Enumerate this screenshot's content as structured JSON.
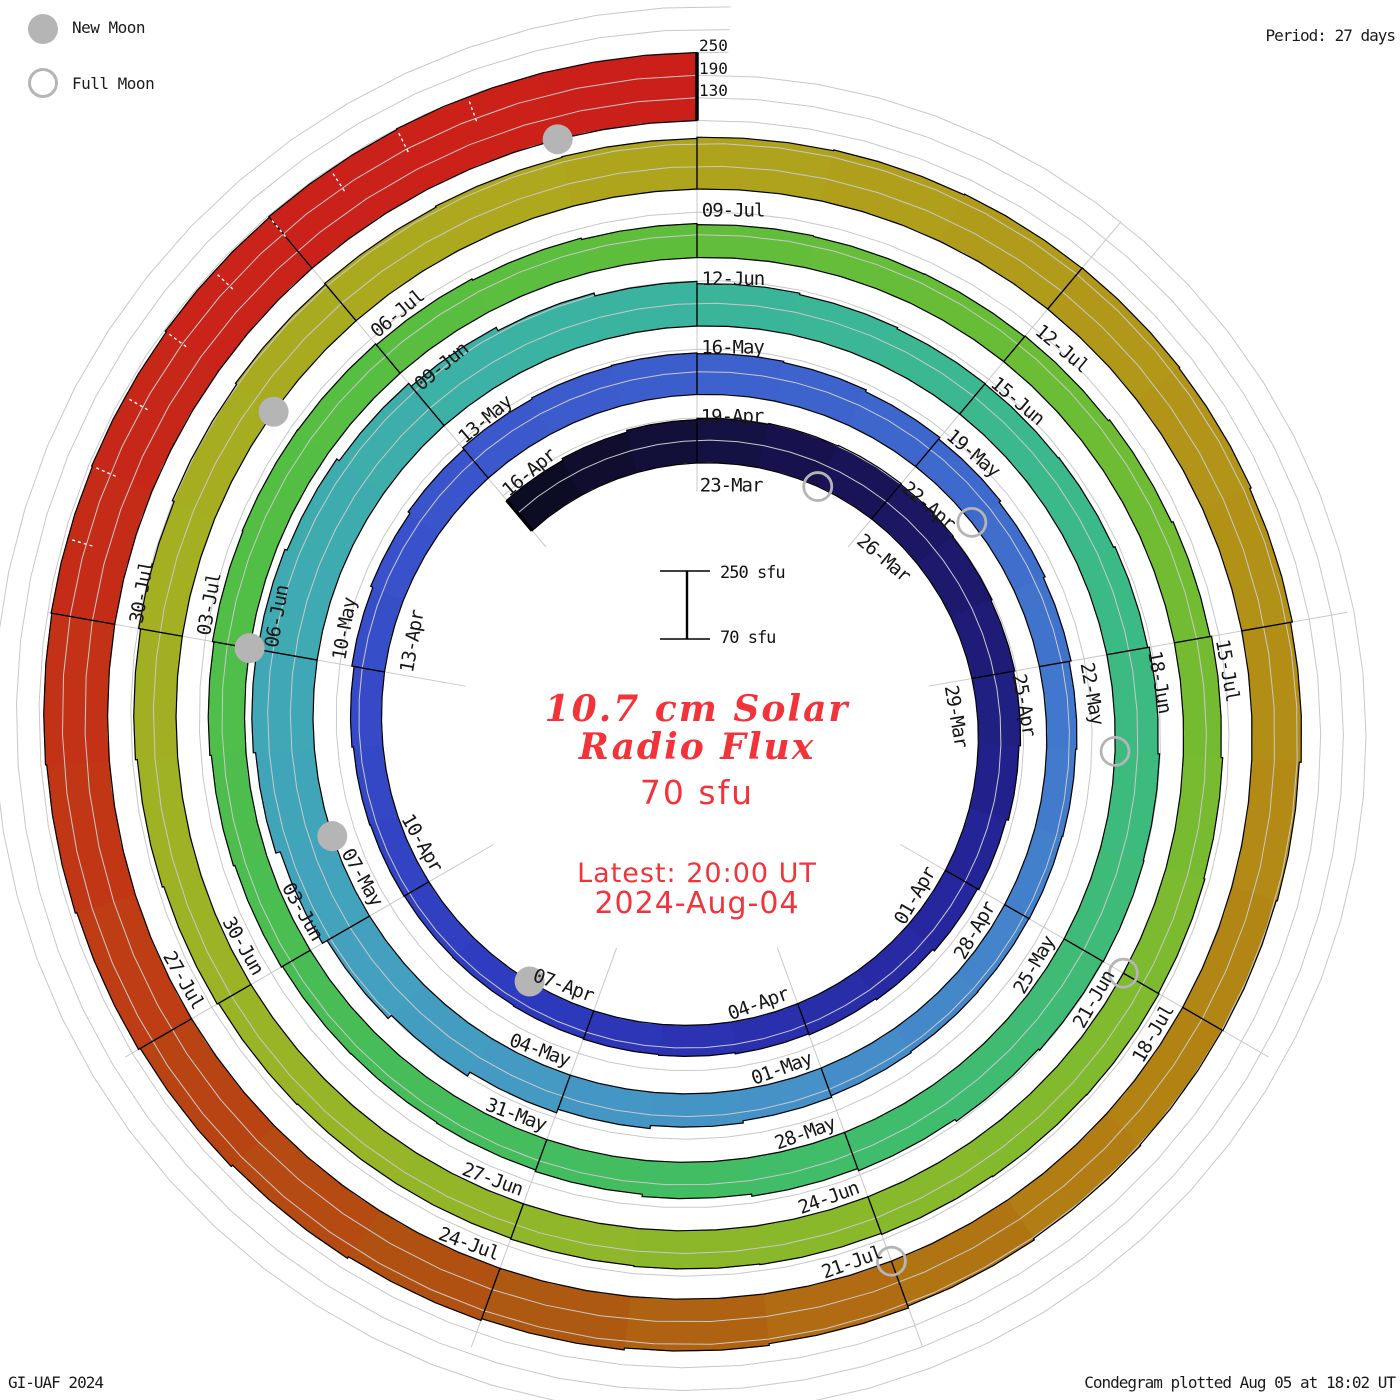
{
  "legend": {
    "new_moon": "New Moon",
    "full_moon": "Full Moon"
  },
  "header": {
    "period_label": "Period: 27 days"
  },
  "footer": {
    "left": "GI-UAF 2024",
    "right": "Condegram plotted Aug 05 at 18:02 UT"
  },
  "outer_scale_labels": [
    "250",
    "190",
    "130"
  ],
  "center": {
    "scale_top_label": "250 sfu",
    "scale_bottom_label": "70 sfu",
    "title_line1": "10.7 cm Solar",
    "title_line2": "Radio Flux",
    "baseline_label": "70 sfu",
    "latest_line1": "Latest: 20:00 UT",
    "latest_line2": "2024-Aug-04"
  },
  "colors": {
    "moon_gray": "#b5b5b5",
    "grid_gray": "#c8c8c8",
    "red_text": "#f2333a",
    "outline_black": "#000000"
  },
  "chart_data": {
    "type": "bar",
    "subtype": "condegram-spiral",
    "title": "10.7 cm Solar Radio Flux",
    "units": "sfu",
    "period_days": 27,
    "start_date": "2024-03-20",
    "first_label_date": "2024-03-23",
    "flux_start_offset_days": -3,
    "sfu_baseline": 70,
    "gridlines_sfu": [
      130,
      190,
      250
    ],
    "latest_value_sfu": 250,
    "values_sfu": [
      175,
      180,
      185,
      188,
      190,
      192,
      190,
      188,
      185,
      182,
      178,
      172,
      168,
      162,
      158,
      155,
      152,
      150,
      148,
      146,
      145,
      146,
      148,
      152,
      158,
      164,
      170,
      175,
      178,
      180,
      178,
      175,
      170,
      165,
      160,
      155,
      150,
      147,
      145,
      144,
      145,
      148,
      152,
      158,
      166,
      176,
      188,
      200,
      214,
      226,
      232,
      230,
      224,
      216,
      206,
      196,
      188,
      182,
      178,
      175,
      174,
      176,
      180,
      184,
      188,
      190,
      188,
      184,
      178,
      172,
      166,
      160,
      156,
      154,
      155,
      158,
      162,
      166,
      170,
      172,
      171,
      168,
      164,
      160,
      157,
      155,
      156,
      158,
      162,
      166,
      170,
      174,
      177,
      179,
      178,
      176,
      173,
      171,
      169,
      167,
      167,
      169,
      173,
      177,
      182,
      187,
      192,
      196,
      199,
      202,
      204,
      207,
      209,
      211,
      212,
      210,
      206,
      201,
      196,
      193,
      191,
      193,
      197,
      202,
      207,
      212,
      217,
      222,
      227,
      232,
      236,
      239,
      241,
      243,
      246,
      248,
      250,
      250
    ],
    "date_label_step_days": 3,
    "date_labels": [
      "23-Mar",
      "26-Mar",
      "29-Mar",
      "01-Apr",
      "04-Apr",
      "07-Apr",
      "10-Apr",
      "13-Apr",
      "16-Apr",
      "19-Apr",
      "22-Apr",
      "25-Apr",
      "28-Apr",
      "01-May",
      "04-May",
      "07-May",
      "10-May",
      "13-May",
      "16-May",
      "19-May",
      "22-May",
      "25-May",
      "28-May",
      "31-May",
      "03-Jun",
      "06-Jun",
      "09-Jun",
      "12-Jun",
      "15-Jun",
      "18-Jun",
      "21-Jun",
      "24-Jun",
      "27-Jun",
      "30-Jun",
      "03-Jul",
      "06-Jul",
      "09-Jul",
      "12-Jul",
      "15-Jul",
      "18-Jul",
      "21-Jul",
      "24-Jul",
      "27-Jul",
      "30-Jul"
    ],
    "new_moon_dates": [
      "2024-04-08",
      "2024-05-08",
      "2024-06-06",
      "2024-07-05",
      "2024-08-04"
    ],
    "full_moon_dates": [
      "2024-03-25",
      "2024-04-23",
      "2024-05-23",
      "2024-06-21",
      "2024-07-21"
    ],
    "new_moon_offsets": [
      16,
      46,
      75,
      104,
      134
    ],
    "full_moon_offsets": [
      2,
      31,
      61,
      90,
      120
    ],
    "colormap": [
      [
        -3,
        "#0c0b20"
      ],
      [
        2,
        "#181352"
      ],
      [
        9,
        "#25259c"
      ],
      [
        16,
        "#2e3abe"
      ],
      [
        23,
        "#3a53cc"
      ],
      [
        31,
        "#3f6ccd"
      ],
      [
        39,
        "#458fc9"
      ],
      [
        46,
        "#42a4bc"
      ],
      [
        53,
        "#3ab4a0"
      ],
      [
        60,
        "#3cba84"
      ],
      [
        68,
        "#42bd62"
      ],
      [
        76,
        "#52be44"
      ],
      [
        84,
        "#69bd36"
      ],
      [
        92,
        "#85b92c"
      ],
      [
        100,
        "#9eb324"
      ],
      [
        107,
        "#aea71d"
      ],
      [
        113,
        "#b29317"
      ],
      [
        118,
        "#b28113"
      ],
      [
        123,
        "#ae5412"
      ],
      [
        127,
        "#c03a14"
      ],
      [
        131,
        "#c8241a"
      ],
      [
        134,
        "#cb2019"
      ]
    ],
    "legend_position": "top-left",
    "grid": true
  }
}
